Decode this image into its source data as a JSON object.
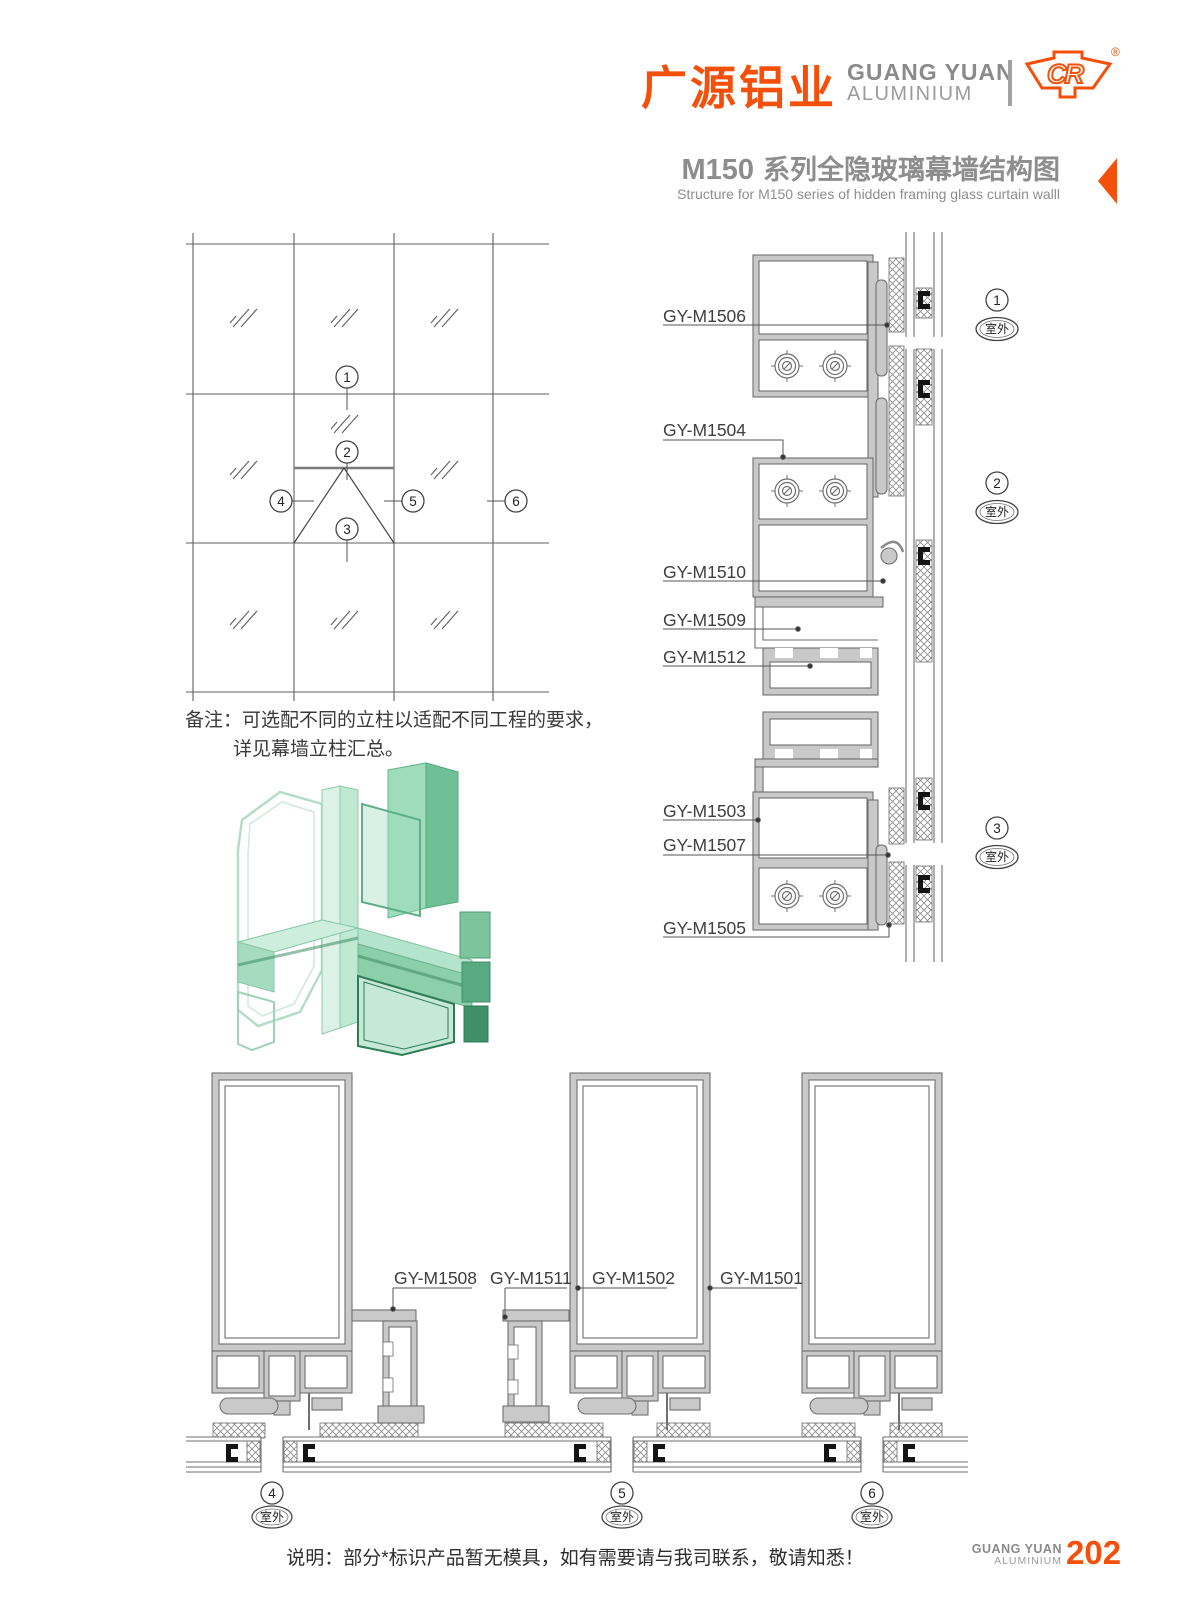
{
  "brand": {
    "cn": "广源铝业",
    "en_line1": "GUANG YUAN",
    "en_line2": "ALUMINIUM",
    "logo_text": "CR",
    "registered_mark": "®"
  },
  "title": {
    "model": "M150",
    "cn": "系列全隐玻璃幕墙结构图",
    "subtitle": "Structure for M150 series of hidden framing glass curtain walll"
  },
  "elevation": {
    "markers": [
      {
        "n": "1"
      },
      {
        "n": "2"
      },
      {
        "n": "3"
      },
      {
        "n": "4"
      },
      {
        "n": "5"
      },
      {
        "n": "6"
      }
    ]
  },
  "remark": {
    "line1": "备注：可选配不同的立柱以适配不同工程的要求，",
    "line2": "详见幕墙立柱汇总。"
  },
  "right_details": {
    "labels": [
      "GY-M1506",
      "GY-M1504",
      "GY-M1510",
      "GY-M1509",
      "GY-M1512",
      "GY-M1503",
      "GY-M1507",
      "GY-M1505"
    ],
    "markers": [
      {
        "n": "1",
        "loc": "室外"
      },
      {
        "n": "2",
        "loc": "室外"
      },
      {
        "n": "3",
        "loc": "室外"
      }
    ]
  },
  "bottom_details": {
    "labels": [
      "GY-M1508",
      "GY-M1511",
      "GY-M1502",
      "GY-M1501"
    ],
    "markers": [
      {
        "n": "4",
        "loc": "室外"
      },
      {
        "n": "5",
        "loc": "室外"
      },
      {
        "n": "6",
        "loc": "室外"
      }
    ]
  },
  "footer": {
    "note": "说明：部分*标识产品暂无模具，如有需要请与我司联系，敬请知悉！",
    "brand_line1": "GUANG YUAN",
    "brand_line2": "ALUMINIUM",
    "page": "202"
  },
  "colors": {
    "accent": "#f4500a",
    "title_gray": "#8d8d8d",
    "drawing_line": "#6f6f6f"
  }
}
